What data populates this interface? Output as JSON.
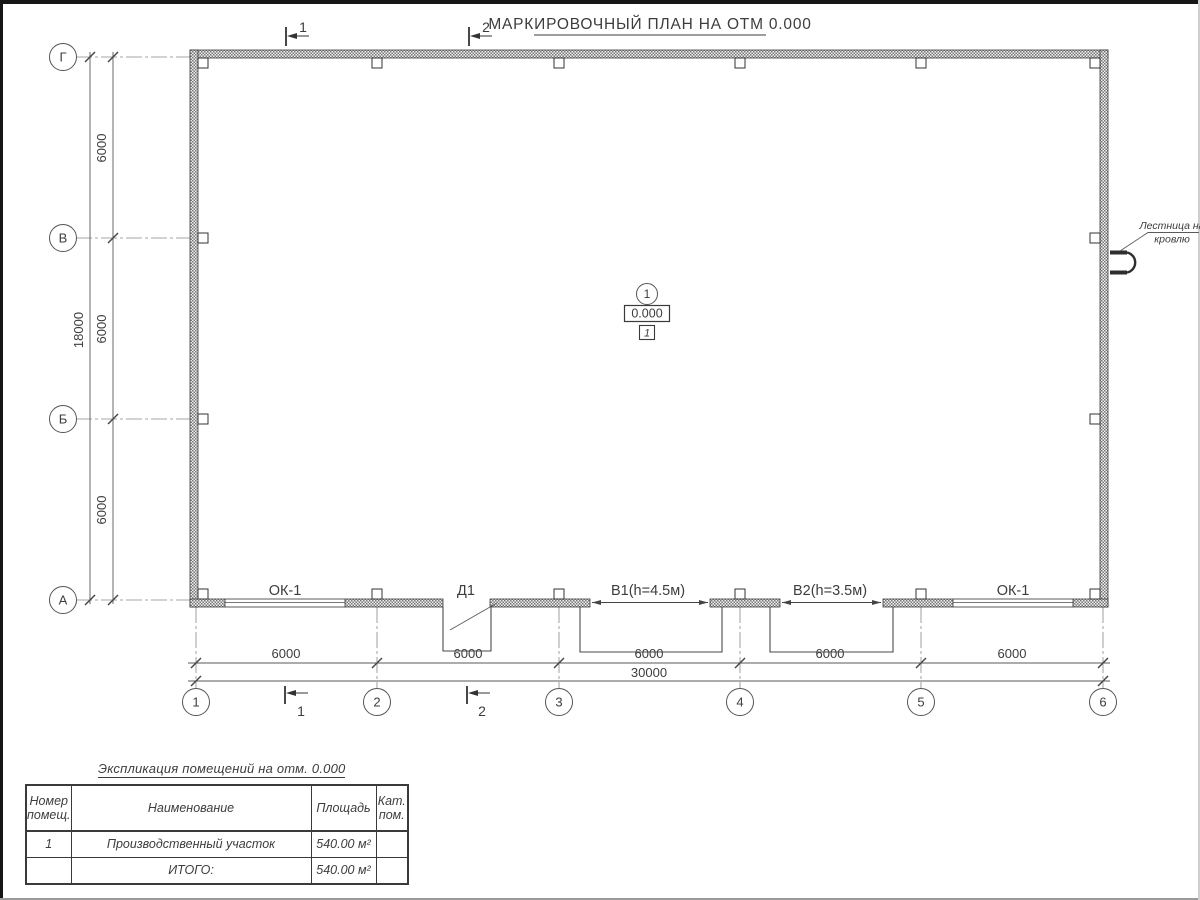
{
  "page": {
    "title": "МАРКИРОВОЧНЫЙ ПЛАН НА ОТМ 0.000"
  },
  "axes": {
    "rows": [
      "Г",
      "В",
      "Б",
      "А"
    ],
    "cols": [
      "1",
      "2",
      "3",
      "4",
      "5",
      "6"
    ]
  },
  "sections": {
    "one": "1",
    "two": "2"
  },
  "dims": {
    "left_bays": [
      "6000",
      "6000",
      "6000"
    ],
    "left_total": "18000",
    "bottom_bays": [
      "6000",
      "6000",
      "6000",
      "6000",
      "6000"
    ],
    "bottom_total": "30000"
  },
  "openings": {
    "ok1_left": "ОК-1",
    "d1": "Д1",
    "v1": "В1(h=4.5м)",
    "v2": "В2(h=3.5м)",
    "ok1_right": "ОК-1"
  },
  "marker": {
    "number": "1",
    "elevation": "0.000",
    "zone": "1"
  },
  "ladder": {
    "line1": "Лестница на",
    "line2": "кровлю"
  },
  "table": {
    "title": "Экспликация помещений на отм. 0.000",
    "headers": {
      "number": "Номер помещ.",
      "name": "Наименование",
      "area": "Площадь",
      "cat": "Кат. пом."
    },
    "rows": [
      {
        "number": "1",
        "name": "Производственный участок",
        "area": "540.00 м²",
        "cat": ""
      }
    ],
    "total_label": "ИТОГО:",
    "total_area": "540.00 м²"
  },
  "colors": {
    "line": "#555555",
    "text": "#3d3d3d",
    "wall": "#777777"
  }
}
